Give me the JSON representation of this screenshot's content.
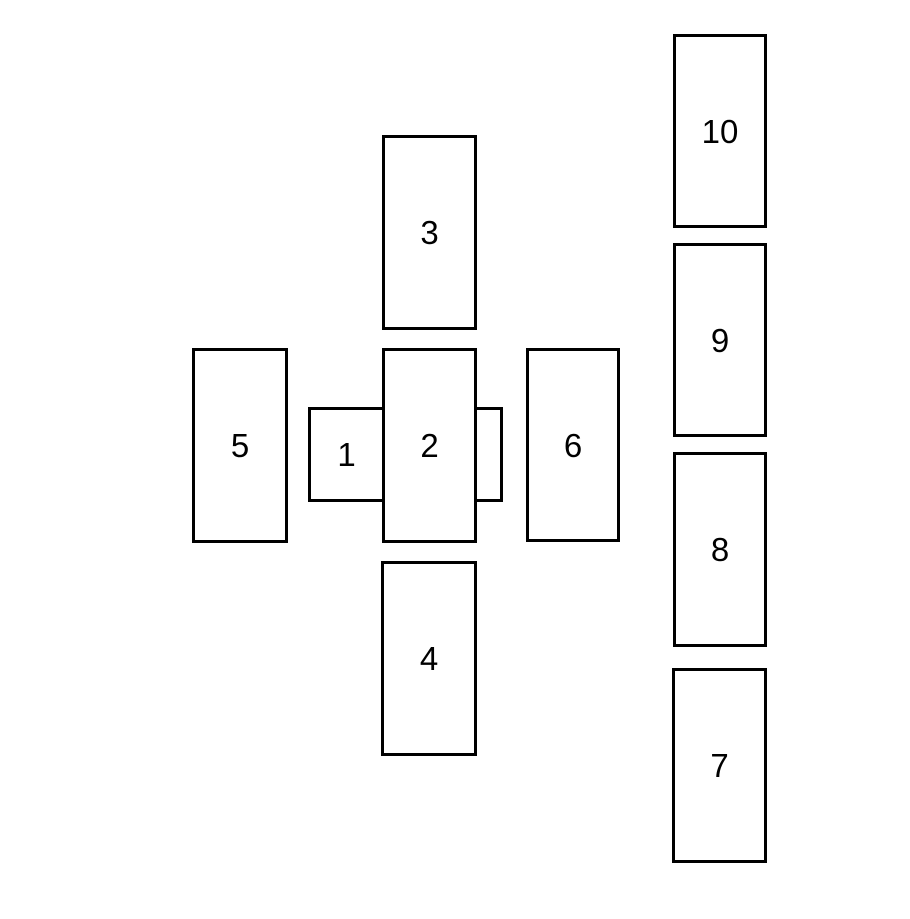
{
  "diagram": {
    "background_color": "#ffffff",
    "card_border_color": "#000000",
    "card_fill_color": "#ffffff",
    "label_color": "#000000"
  },
  "cards": [
    {
      "label": "1"
    },
    {
      "label": "2"
    },
    {
      "label": "3"
    },
    {
      "label": "4"
    },
    {
      "label": "5"
    },
    {
      "label": "6"
    },
    {
      "label": "7"
    },
    {
      "label": "8"
    },
    {
      "label": "9"
    },
    {
      "label": "10"
    }
  ]
}
